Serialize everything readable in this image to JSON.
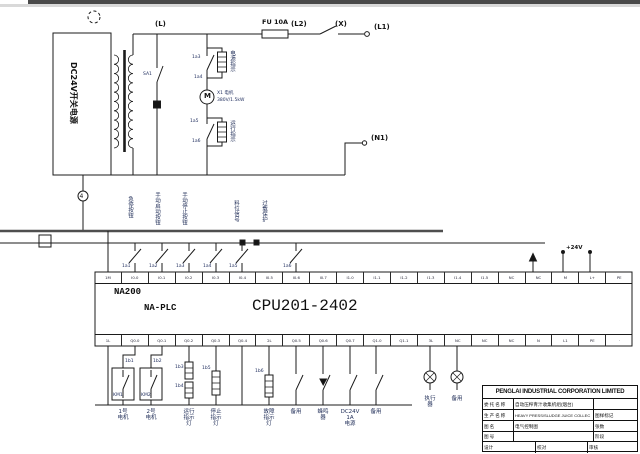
{
  "power": {
    "psu_label": "DC24V开关电源",
    "node_mid": "4"
  },
  "top_line": {
    "l": "(L)",
    "fuse": "FU 10A",
    "l2": "(L2)",
    "x": "(X)",
    "l1": "(L1)",
    "n1": "(N1)"
  },
  "lamp_section": {
    "branch_switch": "SA1",
    "tags": [
      "1a3",
      "1a4",
      "1a5",
      "1a6"
    ],
    "upper_lamp": "电源指示",
    "lower_lamp": "运行指示",
    "motor_symbol": "M",
    "motor_name": "X1 电机",
    "motor_rating": "380V/1.5kW"
  },
  "inputs": {
    "labels": [
      "急停按钮",
      "手动启动按钮",
      "手动停止按钮",
      "料位信号",
      "过载保护"
    ],
    "tags": [
      "1a1",
      "1a2",
      "1a3",
      "1a4",
      "1a5",
      "1a6"
    ]
  },
  "plc": {
    "model": "NA200",
    "series": "NA-PLC",
    "cpu": "CPU201-2402",
    "power_label": "+24V",
    "top_terminals": [
      "1M",
      "I0.0",
      "I0.1",
      "I0.2",
      "I0.3",
      "I0.4",
      "I0.5",
      "I0.6",
      "I0.7",
      "I1.0",
      "I1.1",
      "I1.2",
      "I1.3",
      "I1.4",
      "I1.5",
      "NC",
      "NC",
      "M",
      "L+",
      "PE"
    ],
    "bottom_terminals": [
      "1L",
      "Q0.0",
      "Q0.1",
      "Q0.2",
      "Q0.3",
      "Q0.4",
      "2L",
      "Q0.5",
      "Q0.6",
      "Q0.7",
      "Q1.0",
      "Q1.1",
      "3L",
      "NC",
      "NC",
      "NC",
      "N",
      "L1",
      "PE",
      "·"
    ]
  },
  "outputs": {
    "km_labels": [
      "KM1",
      "KM2"
    ],
    "tags": [
      "1b1",
      "1b2",
      "1b3",
      "1b4",
      "1b5",
      "1b6"
    ],
    "labels": [
      "1号\n电机",
      "2号\n电机",
      "运行\n指示\n灯",
      "停止\n指示\n灯",
      "故障\n指示\n灯",
      "备用",
      "蜂鸣\n器",
      "DC24V\n1A\n电源",
      "备用",
      "执行\n器",
      "备用"
    ]
  },
  "titleblock": {
    "company": "PENGLAI INDUSTRIAL CORPORATION LIMITED",
    "rows": [
      {
        "label": "委托名称",
        "value": "自动压榨青汁收集机组(烟台)",
        "right": ""
      },
      {
        "label": "生产名称",
        "value": "HEAVY PRESS/SLUDGE JUICE COLLEC",
        "right": "图样标记"
      },
      {
        "label": "图名",
        "value": "电气控制图",
        "right": "张数"
      },
      {
        "label": "图号",
        "value": "",
        "right": "阶段"
      },
      {
        "label": "设计",
        "value": "校对",
        "right": "审核"
      }
    ]
  }
}
